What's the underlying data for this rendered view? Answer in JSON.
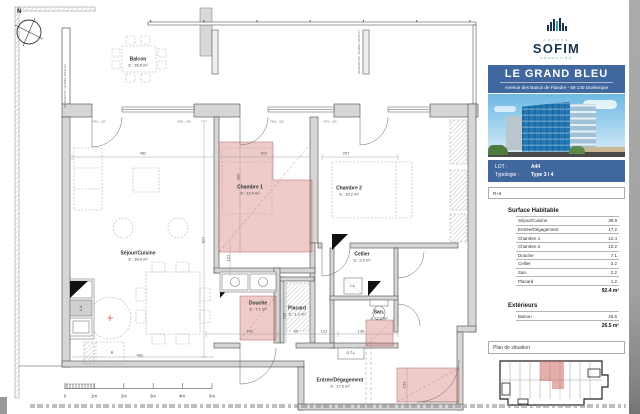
{
  "plan": {
    "compass": "N",
    "separator_text": "SEPARATIF VERRE OPALIN",
    "rooms": {
      "balcon": {
        "name": "Balcon",
        "area": "S : 26.5 m²"
      },
      "sejour": {
        "name": "Séjour/Cuisine",
        "area": "S : 39.9 m²"
      },
      "chambre1": {
        "name": "Chambre 1",
        "area": "S : 12.4 m²"
      },
      "chambre2": {
        "name": "Chambre 2",
        "area": "S : 10.2 m²"
      },
      "douche": {
        "name": "Douche",
        "area": "S : 7.1 m²"
      },
      "placard": {
        "name": "Placard",
        "area": "S : 1.2 m²"
      },
      "cellier": {
        "name": "Cellier",
        "area": "S : 2.2 m²"
      },
      "san": {
        "name": "San.",
        "area": "S : 2.2 m²"
      },
      "entree": {
        "name": "Entrée/Dégagement",
        "area": "S : 17.2 m²"
      }
    },
    "appliances": {
      "ll": "L.L.",
      "lv": "L.V.",
      "gtl": "G.T.L.",
      "fridge": "R"
    },
    "window_labels": [
      {
        "t": "PF1 - VR",
        "x": 99,
        "y": 122
      },
      {
        "t": "FB2 - VR",
        "x": 184,
        "y": 122
      },
      {
        "t": "FB3 - VR",
        "x": 277,
        "y": 122
      },
      {
        "t": "PF2 - VR",
        "x": 330,
        "y": 122
      }
    ],
    "dims": [
      {
        "t": "482",
        "x": 143,
        "y": 153
      },
      {
        "t": "312",
        "x": 264,
        "y": 153
      },
      {
        "t": "257",
        "x": 346,
        "y": 153
      },
      {
        "t": "460",
        "x": 238,
        "y": 177,
        "rot": 1
      },
      {
        "t": "827",
        "x": 203,
        "y": 240,
        "rot": 1
      },
      {
        "t": "122",
        "x": 228,
        "y": 258,
        "rot": 1
      },
      {
        "t": "206",
        "x": 284,
        "y": 316,
        "rot": 1
      },
      {
        "t": "482",
        "x": 140,
        "y": 355
      },
      {
        "t": "242",
        "x": 250,
        "y": 331
      },
      {
        "t": "69",
        "x": 296,
        "y": 331
      },
      {
        "t": "122",
        "x": 324,
        "y": 331
      },
      {
        "t": "138",
        "x": 361,
        "y": 331
      },
      {
        "t": "153",
        "x": 404,
        "y": 385,
        "rot": 1
      }
    ],
    "scalebar": [
      {
        "t": "0",
        "x": 65,
        "y": 396
      },
      {
        "t": "1m",
        "x": 94,
        "y": 396
      },
      {
        "t": "2m",
        "x": 124,
        "y": 396
      },
      {
        "t": "3m",
        "x": 153,
        "y": 396
      },
      {
        "t": "4m",
        "x": 182,
        "y": 396
      },
      {
        "t": "5m",
        "x": 212,
        "y": 396
      }
    ]
  },
  "sidebar": {
    "logo": {
      "group": "GROUPE",
      "name": "SOFIM",
      "sub": "PROMOTION"
    },
    "project": {
      "title": "LE GRAND BLEU",
      "address": "Avenue des Bancs de Flandre - 59 140 Dunkerque"
    },
    "lot": {
      "lot_label": "LOT :",
      "lot_value": "A44",
      "typo_label": "Typologie :",
      "typo_value": "Type 3 / 4"
    },
    "floor": "R+6",
    "surface": {
      "title": "Surface Habitable",
      "rows": [
        {
          "label": "Séjour/Cuisine",
          "value": "39.9"
        },
        {
          "label": "Entrée/Dégagement",
          "value": "17.2"
        },
        {
          "label": "Chambre 1",
          "value": "12.4"
        },
        {
          "label": "Chambre 2",
          "value": "10.2"
        },
        {
          "label": "Douche",
          "value": "7.1"
        },
        {
          "label": "Cellier",
          "value": "2.2"
        },
        {
          "label": "San.",
          "value": "2.2"
        },
        {
          "label": "Placard",
          "value": "1.2"
        }
      ],
      "total": "92.4 m²"
    },
    "exterior": {
      "title": "Extérieurs",
      "rows": [
        {
          "label": "Balcon",
          "value": "26.5"
        }
      ],
      "total": "26.5 m²"
    },
    "situation": {
      "title": "Plan de situation"
    }
  },
  "colors": {
    "accent_blue": "#40689e",
    "navy": "#17344f",
    "teal": "#3aa9a0",
    "pink_zone": "#cd5d56"
  }
}
